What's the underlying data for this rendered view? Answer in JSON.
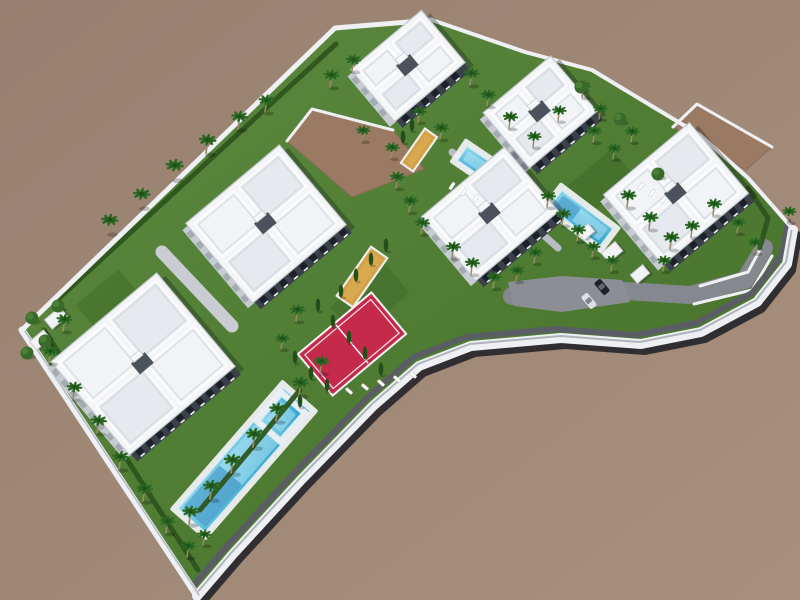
{
  "meta": {
    "alt": "Aerial 3D architectural rendering of a white Mediterranean apartment complex with pools, palm trees, a red padel court and curved white perimeter road on bare brown land"
  },
  "palette": {
    "ground_a": "#97806f",
    "ground_b": "#a8907d",
    "grass_a": "#5d8b3f",
    "grass_b": "#436e29",
    "grass_dark": "#2e5a1e",
    "hedge": "#2d541c",
    "roof_white": "#f4f5f7",
    "roof_line": "#c6cbd2",
    "roof_mid": "#e6e9ee",
    "facade_dark": "#3a414b",
    "facade_light": "#c7ccd3",
    "wall_white": "#eef0f3",
    "wall_cap": "#a7adb5",
    "wall_shadow": "#1d1d24",
    "walkway": "#5a5d63",
    "road_gray": "#85888e",
    "path_light": "#c9cdd3",
    "path_mid": "#b9bdc3",
    "parking": "#8b8e94",
    "pool_deck": "#eef0f3",
    "pool_a": "#8ed9ee",
    "pool_b": "#2e9fcc",
    "pool_light": "#bfeaf6",
    "pool_deep": "#1f7fb8",
    "court_red": "#c62a4a",
    "court_line": "#f2f3f6",
    "sand_yellow": "#d9a94f",
    "dirt": "#9b7a63",
    "palm_green": "#2e6b26",
    "palm_green2": "#25601f",
    "palm_trunk": "#9b8a68",
    "cypress": "#224e19",
    "leafy": "#3a6a2b",
    "leafy2": "#4a7f36",
    "car_dark": "#1e2026",
    "car_white": "#dfe1e6",
    "shadow": "#14141c"
  },
  "scene": {
    "site": {
      "outline": [
        [
          22,
          330
        ],
        [
          335,
          28
        ],
        [
          432,
          20
        ],
        [
          525,
          52
        ],
        [
          592,
          70
        ],
        [
          650,
          105
        ],
        [
          700,
          135
        ],
        [
          748,
          178
        ],
        [
          792,
          228
        ],
        [
          786,
          262
        ],
        [
          756,
          300
        ],
        [
          700,
          330
        ],
        [
          640,
          342
        ],
        [
          560,
          336
        ],
        [
          470,
          344
        ],
        [
          418,
          364
        ],
        [
          372,
          404
        ],
        [
          300,
          478
        ],
        [
          232,
          552
        ],
        [
          196,
          594
        ]
      ],
      "se_from_index": 8
    },
    "lawdark": [
      [
        370,
        300,
        70,
        40,
        -40
      ],
      [
        600,
        182,
        60,
        36,
        -40
      ],
      [
        108,
        300,
        56,
        34,
        -40
      ],
      [
        520,
        120,
        44,
        28,
        -40
      ]
    ],
    "dirt_plots": [
      {
        "id": "dirt-plot-west",
        "pts": [
          [
            287,
            141
          ],
          [
            312,
            109
          ],
          [
            393,
            130
          ],
          [
            424,
            169
          ],
          [
            352,
            197
          ]
        ],
        "wall": [
          [
            287,
            141
          ],
          [
            312,
            109
          ],
          [
            393,
            130
          ]
        ]
      },
      {
        "id": "dirt-plot-northeast",
        "pts": [
          [
            673,
            127
          ],
          [
            697,
            104
          ],
          [
            772,
            147
          ],
          [
            746,
            170
          ]
        ],
        "wall": [
          [
            673,
            127
          ],
          [
            697,
            104
          ],
          [
            772,
            147
          ]
        ]
      }
    ],
    "roads": [
      {
        "id": "internal-drive",
        "pts": [
          [
            512,
            296
          ],
          [
            610,
            290
          ],
          [
            690,
            295
          ],
          [
            745,
            280
          ],
          [
            764,
            248
          ]
        ],
        "w": 18,
        "color": "road_gray"
      },
      {
        "id": "entrance-ramp",
        "pts": [
          [
            162,
            252
          ],
          [
            232,
            326
          ]
        ],
        "w": 13,
        "color": "path_light"
      },
      {
        "id": "garden-path",
        "pts": [
          [
            452,
            152
          ],
          [
            502,
            198
          ],
          [
            558,
            248
          ]
        ],
        "w": 7,
        "color": "path_mid"
      }
    ],
    "parking": [
      [
        508,
        282
      ],
      [
        562,
        276
      ],
      [
        622,
        280
      ],
      [
        630,
        302
      ],
      [
        562,
        312
      ],
      [
        514,
        306
      ]
    ],
    "curbs": [
      [
        [
          700,
          286
        ],
        [
          748,
          272
        ],
        [
          762,
          246
        ]
      ],
      [
        [
          694,
          304
        ],
        [
          752,
          290
        ],
        [
          772,
          256
        ]
      ]
    ],
    "courts": {
      "padel": {
        "cx": 352,
        "cy": 344,
        "l": 96,
        "w": 54,
        "angle": -40
      },
      "sand": [
        {
          "cx": 362,
          "cy": 277,
          "l": 60,
          "w": 20,
          "angle": -55
        },
        {
          "cx": 419,
          "cy": 150,
          "l": 42,
          "w": 15,
          "angle": -55
        }
      ]
    },
    "pools": [
      {
        "id": "pool-main-lap",
        "cx": 244,
        "cy": 460,
        "l": 160,
        "w": 36,
        "angle": -49,
        "deep": true
      },
      {
        "id": "pool-main-arm",
        "cx": 281,
        "cy": 417,
        "l": 32,
        "w": 26,
        "angle": -49,
        "deep": false
      },
      {
        "id": "pool-east",
        "cx": 581,
        "cy": 218,
        "l": 64,
        "w": 21,
        "angle": 37,
        "deep": true
      },
      {
        "id": "pool-center",
        "cx": 478,
        "cy": 164,
        "l": 38,
        "w": 17,
        "angle": 34,
        "deep": false
      }
    ],
    "hedges": [
      [
        [
          44,
          330
        ],
        [
          198,
          570
        ]
      ],
      [
        [
          200,
          510
        ],
        [
          300,
          390
        ]
      ],
      [
        [
          56,
          301
        ],
        [
          336,
          44
        ]
      ],
      [
        [
          748,
          188
        ],
        [
          768,
          218
        ],
        [
          760,
          248
        ]
      ]
    ],
    "buildings": [
      {
        "id": "block-north",
        "cx": 408,
        "cy": 66,
        "w": 92,
        "h": 68,
        "angle": -40
      },
      {
        "id": "block-northeast",
        "cx": 540,
        "cy": 112,
        "w": 88,
        "h": 72,
        "angle": -40
      },
      {
        "id": "block-east",
        "cx": 676,
        "cy": 194,
        "w": 112,
        "h": 92,
        "angle": -40
      },
      {
        "id": "block-center",
        "cx": 490,
        "cy": 214,
        "w": 108,
        "h": 84,
        "angle": -40
      },
      {
        "id": "block-west",
        "cx": 266,
        "cy": 224,
        "w": 122,
        "h": 104,
        "angle": -40
      },
      {
        "id": "block-southwest",
        "cx": 143,
        "cy": 364,
        "w": 138,
        "h": 122,
        "angle": -40
      }
    ],
    "pergolas": [
      {
        "x": 612,
        "y": 252,
        "w": 18,
        "h": 12,
        "angle": -40
      },
      {
        "x": 640,
        "y": 274,
        "w": 16,
        "h": 11,
        "angle": -40
      },
      {
        "x": 586,
        "y": 232,
        "w": 14,
        "h": 10,
        "angle": -40
      },
      {
        "x": 56,
        "y": 318,
        "w": 20,
        "h": 12,
        "angle": -40
      },
      {
        "x": 40,
        "y": 340,
        "w": 18,
        "h": 11,
        "angle": -40
      }
    ],
    "loungers": [
      [
        349,
        391,
        41
      ],
      [
        365,
        387,
        41
      ],
      [
        381,
        383,
        41
      ],
      [
        397,
        379,
        41
      ],
      [
        413,
        375,
        41
      ],
      [
        641,
        186,
        127
      ],
      [
        652,
        193,
        127
      ],
      [
        663,
        200,
        127
      ],
      [
        452,
        186,
        124
      ],
      [
        464,
        192,
        124
      ],
      [
        476,
        198,
        124
      ]
    ],
    "cars": [
      {
        "x": 602,
        "y": 287,
        "angle": 50,
        "color": "car_dark"
      },
      {
        "x": 589,
        "y": 301,
        "angle": 50,
        "color": "car_white"
      }
    ],
    "trees": {
      "palms": [
        [
          108,
          233,
          1.1
        ],
        [
          140,
          207,
          1.1
        ],
        [
          173,
          179,
          1.15
        ],
        [
          206,
          153,
          1.1
        ],
        [
          238,
          129,
          1.05
        ],
        [
          265,
          112,
          1.0
        ],
        [
          330,
          87,
          1.0
        ],
        [
          352,
          71,
          0.95
        ],
        [
          470,
          85,
          1.0
        ],
        [
          487,
          106,
          0.95
        ],
        [
          440,
          139,
          0.95
        ],
        [
          418,
          122,
          0.9
        ],
        [
          509,
          128,
          0.95
        ],
        [
          533,
          147,
          0.9
        ],
        [
          558,
          121,
          0.9
        ],
        [
          582,
          97,
          0.95
        ],
        [
          599,
          119,
          0.9
        ],
        [
          593,
          142,
          0.95
        ],
        [
          613,
          159,
          0.9
        ],
        [
          631,
          142,
          0.9
        ],
        [
          627,
          207,
          1.0
        ],
        [
          649,
          229,
          1.0
        ],
        [
          670,
          249,
          1.0
        ],
        [
          691,
          237,
          0.95
        ],
        [
          713,
          215,
          0.95
        ],
        [
          737,
          233,
          0.9
        ],
        [
          754,
          253,
          0.9
        ],
        [
          663,
          271,
          0.9
        ],
        [
          788,
          222,
          0.9
        ],
        [
          547,
          207,
          0.95
        ],
        [
          562,
          225,
          0.95
        ],
        [
          577,
          241,
          0.95
        ],
        [
          592,
          257,
          0.9
        ],
        [
          611,
          271,
          0.9
        ],
        [
          452,
          258,
          0.95
        ],
        [
          471,
          274,
          0.95
        ],
        [
          493,
          288,
          0.95
        ],
        [
          516,
          281,
          0.9
        ],
        [
          534,
          263,
          0.9
        ],
        [
          396,
          188,
          0.95
        ],
        [
          409,
          212,
          0.95
        ],
        [
          421,
          234,
          0.95
        ],
        [
          362,
          141,
          0.9
        ],
        [
          391,
          158,
          0.9
        ],
        [
          296,
          321,
          0.95
        ],
        [
          281,
          349,
          0.9
        ],
        [
          320,
          373,
          1.0
        ],
        [
          299,
          395,
          1.05
        ],
        [
          276,
          421,
          1.05
        ],
        [
          253,
          447,
          1.1
        ],
        [
          231,
          473,
          1.1
        ],
        [
          210,
          499,
          1.1
        ],
        [
          189,
          524,
          1.05
        ],
        [
          63,
          331,
          1.0
        ],
        [
          49,
          363,
          1.0
        ],
        [
          73,
          399,
          1.0
        ],
        [
          97,
          433,
          1.05
        ],
        [
          119,
          469,
          1.05
        ],
        [
          143,
          501,
          1.05
        ],
        [
          166,
          533,
          1.0
        ],
        [
          187,
          557,
          0.95
        ],
        [
          203,
          545,
          0.9
        ]
      ],
      "cypresses": [
        [
          318,
          311
        ],
        [
          333,
          327
        ],
        [
          349,
          343
        ],
        [
          365,
          359
        ],
        [
          381,
          375
        ],
        [
          295,
          363
        ],
        [
          311,
          379
        ],
        [
          341,
          297
        ],
        [
          356,
          281
        ],
        [
          371,
          265
        ],
        [
          386,
          251
        ],
        [
          327,
          391
        ],
        [
          300,
          407
        ],
        [
          403,
          143
        ],
        [
          412,
          131
        ]
      ],
      "leafy": [
        [
          32,
          320
        ],
        [
          45,
          343
        ],
        [
          27,
          355
        ],
        [
          58,
          308
        ],
        [
          620,
          121
        ],
        [
          581,
          89
        ],
        [
          658,
          176
        ]
      ]
    }
  }
}
